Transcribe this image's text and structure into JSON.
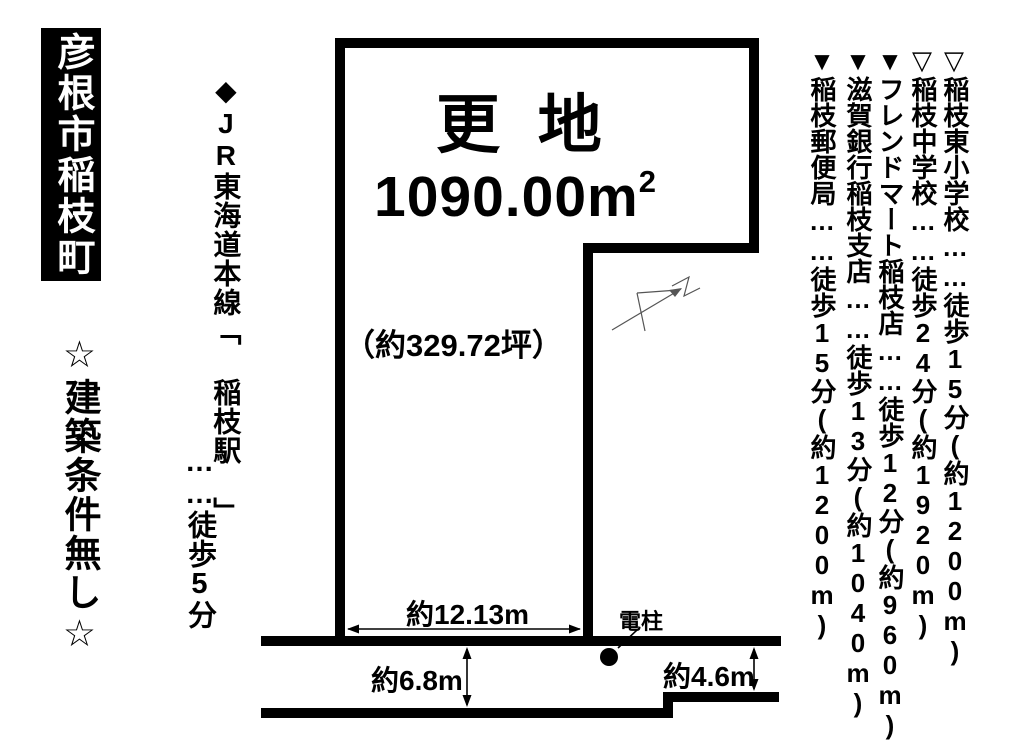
{
  "colors": {
    "ink": "#000000",
    "background": "#ffffff",
    "thin_line": "#555555"
  },
  "location_badge": {
    "text": "彦根市稲枝町"
  },
  "condition_note": {
    "text": "☆建築条件無し☆"
  },
  "station_access": {
    "line_station": "◆JR東海道本線「 稲枝駅 」",
    "walk_time": "……徒歩5分"
  },
  "plot": {
    "status": "更 地",
    "area_number": "1090.00",
    "area_unit": "m",
    "area_exponent": "2",
    "area_tsubo": "（約329.72坪）"
  },
  "dimensions": {
    "frontage": "約12.13m",
    "road_width_left": "約6.8m",
    "road_width_right": "約4.6m",
    "utility_pole": "電柱"
  },
  "facilities": [
    "▽稲枝東小学校……徒歩15分(約1200m)",
    "▽稲枝中学校……徒歩24分(約1920m)",
    "▼フレンドマート稲枝店……徒歩12分(約960m)",
    "▼滋賀銀行稲枝支店……徒歩13分(約1040m)",
    "▼稲枝郵便局……徒歩15分(約1200m)"
  ]
}
